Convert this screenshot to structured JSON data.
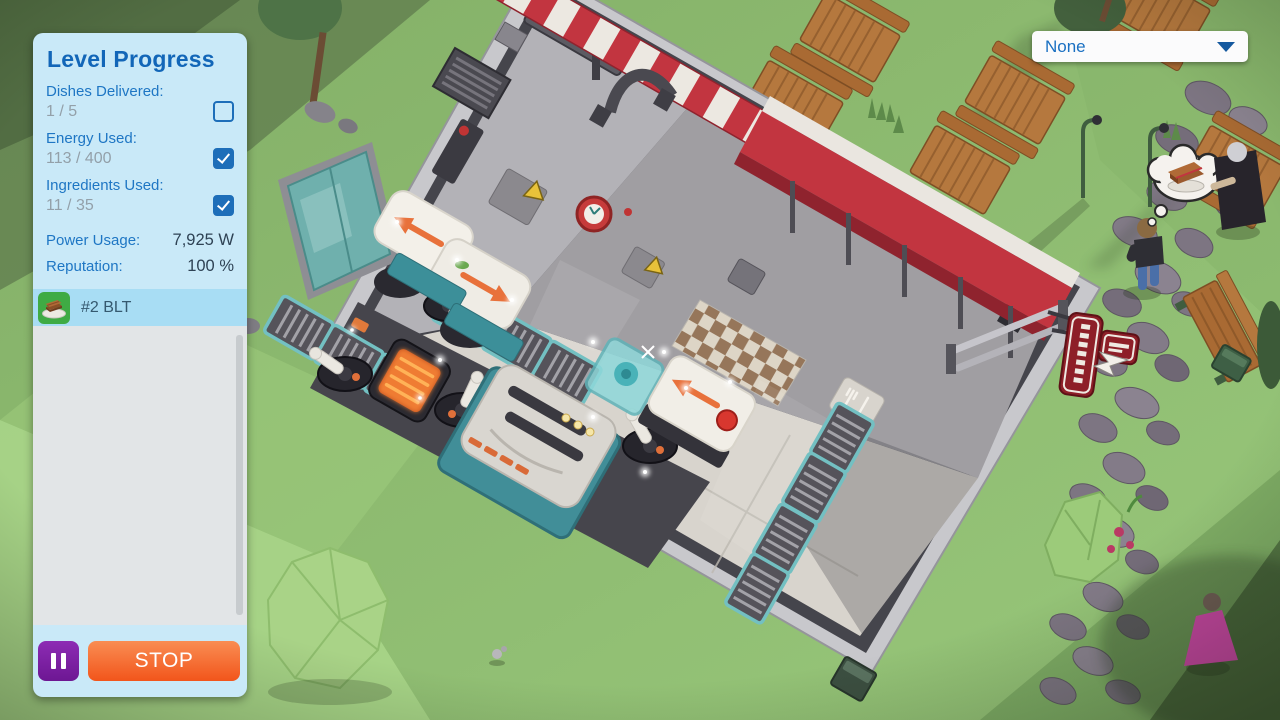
{
  "level_progress": {
    "title": "Level Progress",
    "objectives": [
      {
        "label": "Dishes Delivered:",
        "value": "1 / 5",
        "checked": false
      },
      {
        "label": "Energy Used:",
        "value": "113 / 400",
        "checked": true
      },
      {
        "label": "Ingredients Used:",
        "value": "11 / 35",
        "checked": true
      }
    ],
    "stats": [
      {
        "label": "Power Usage:",
        "value": "7,925 W"
      },
      {
        "label": "Reputation:",
        "value": "100 %"
      }
    ],
    "orders": [
      {
        "label": "#2 BLT",
        "icon": "blt-dish-icon"
      }
    ],
    "controls": {
      "pause_icon": "pause-icon",
      "stop_label": "STOP"
    }
  },
  "camera_dropdown": {
    "selected": "None",
    "icon": "chevron-down-icon"
  },
  "colors": {
    "panel_bg": "#c9e9f8",
    "accent_blue": "#1a70c0",
    "value_muted": "#93a0a9",
    "value_dark": "#2e4254",
    "checkbox_blue": "#1d6eb9",
    "order_row_bg": "#a8ddf4",
    "order_icon_green": "#3fab44",
    "pause_purple": "#7b1fa2",
    "stop_orange": "#f2551b",
    "awning_red": "#c23540",
    "grass_green": "#8fbd72"
  }
}
